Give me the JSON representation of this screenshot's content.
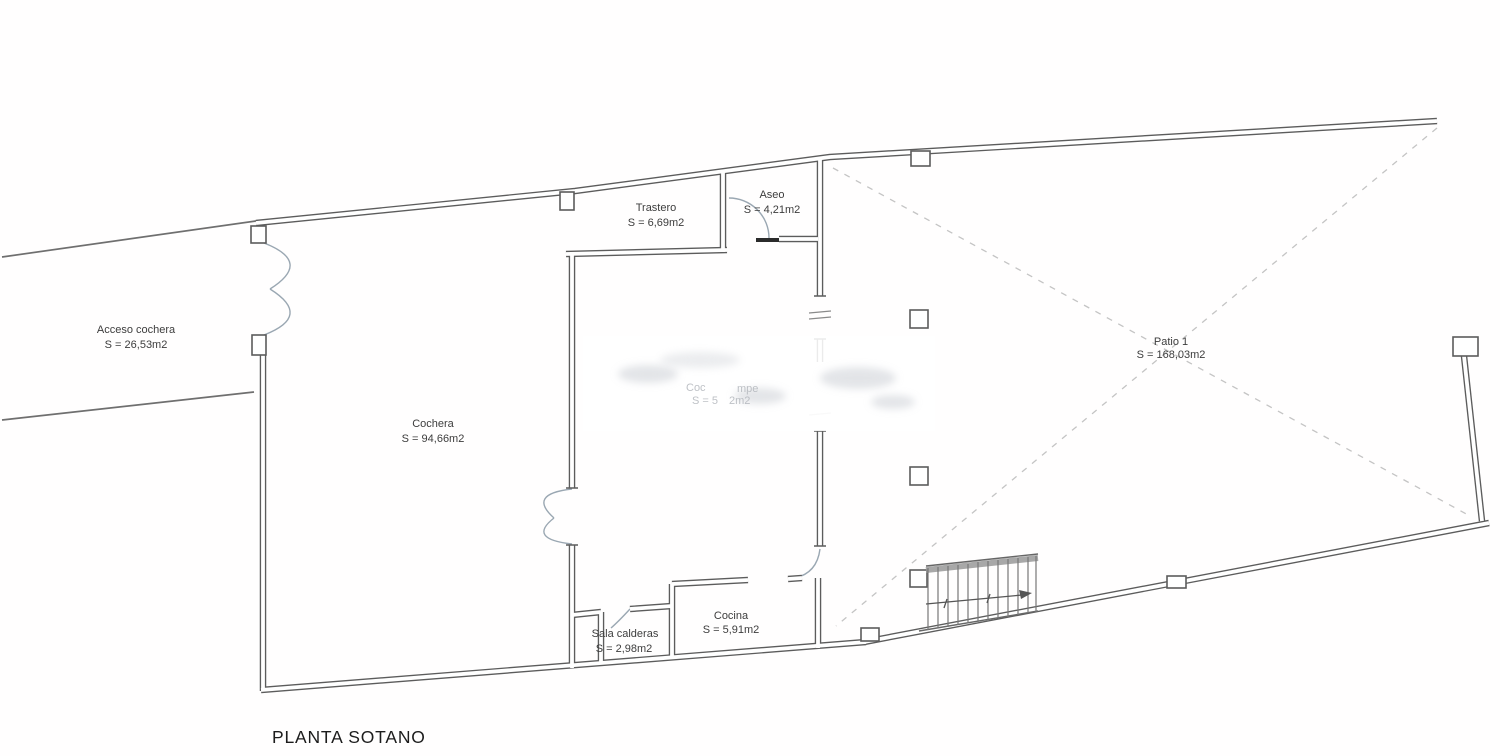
{
  "drawing_title": "PLANTA SOTANO",
  "colors": {
    "wall": "#5c5c5c",
    "label": "#3d3d3d",
    "faded_label": "#aeb2b8",
    "dashed_diagonal": "#c4c4c4",
    "door_arc": "#9aa7b2"
  },
  "rooms": {
    "acceso": {
      "name": "Acceso cochera",
      "area": "S = 26,53m2"
    },
    "cochera": {
      "name": "Cochera",
      "area": "S = 94,66m2"
    },
    "trastero": {
      "name": "Trastero",
      "area": "S = 6,69m2"
    },
    "aseo": {
      "name": "Aseo",
      "area": "S = 4,21m2"
    },
    "patio": {
      "name": "Patio 1",
      "area": "S = 168,03m2"
    },
    "sala_calderas": {
      "name": "Sala calderas",
      "area": "S = 2,98m2"
    },
    "cocina": {
      "name": "Cocina",
      "area": "S = 5,91m2"
    },
    "central_faded": {
      "name_fragment_1": "Coc",
      "name_fragment_2": "mpe",
      "area_fragment_1": "S = 5",
      "area_fragment_2": "2m2"
    }
  }
}
